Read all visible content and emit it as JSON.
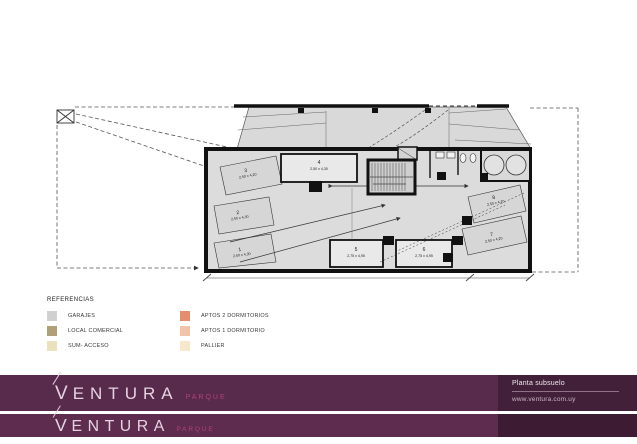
{
  "plan": {
    "spaces": [
      {
        "id": "1",
        "dims": "2,50 x 4,30"
      },
      {
        "id": "2",
        "dims": "2,50 x 4,30"
      },
      {
        "id": "3",
        "dims": "2,50 x 4,20"
      },
      {
        "id": "4",
        "dims": "2,50 x 4,30"
      },
      {
        "id": "5",
        "dims": "2,75 x 4,95"
      },
      {
        "id": "6",
        "dims": "2,75 x 4,95"
      },
      {
        "id": "7",
        "dims": "2,50 x 4,20"
      },
      {
        "id": "8",
        "dims": "2,50 x 4,20"
      }
    ]
  },
  "legend": {
    "title": "REFERENCIAS",
    "items": [
      {
        "label": "GARAJES",
        "color": "#d0d0d0"
      },
      {
        "label": "LOCAL COMERCIAL",
        "color": "#b19f7a"
      },
      {
        "label": "SUM- ACCESO",
        "color": "#ebe2bd"
      },
      {
        "label": "APTOS 2 DORMITORIOS",
        "color": "#e58d6f"
      },
      {
        "label": "APTOS 1 DORMITORIO",
        "color": "#f1c3a9"
      },
      {
        "label": "PALLIER",
        "color": "#f6e9cb"
      }
    ]
  },
  "footer": {
    "brand": {
      "initial": "V",
      "rest": "ENTURA",
      "sub": "PARQUE"
    },
    "plan_title": "Planta subsuelo",
    "website": "www.ventura.com.uy",
    "colors": {
      "bar1": "#582a4b",
      "bar2": "#5d2c4f",
      "panel": "#432039",
      "panel2": "#3c1b33",
      "accent": "#b6407c"
    }
  }
}
